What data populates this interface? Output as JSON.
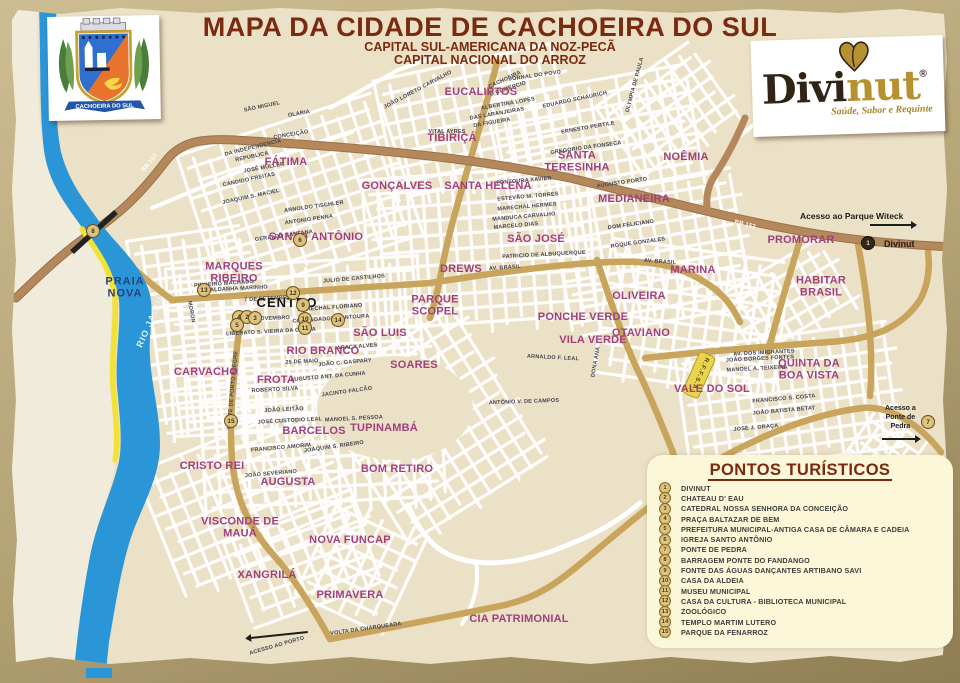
{
  "header": {
    "title": "MAPA DA CIDADE DE CACHOEIRA DO SUL",
    "subtitle1": "CAPITAL SUL-AMERICANA DA NOZ-PECÃ",
    "subtitle2": "CAPITAL NACIONAL DO ARROZ"
  },
  "crest": {
    "banner": "CACHOEIRA DO SUL"
  },
  "logo": {
    "word_dark": "Divi",
    "word_gold": "nut",
    "registered": "®",
    "tagline": "Saúde, Sabor e Requinte"
  },
  "map": {
    "river_label": "RIO JACUÍ",
    "railway_label": "R.F.F.S.A.",
    "access_parque": "Acesso ao Parque Witeck",
    "access_parque_marker_label": "Divinut",
    "access_ponte": "Acesso a\nPonte de\nPedra",
    "access_porto": "ACESSO AO PORTO",
    "colors": {
      "district": "#a13f7e",
      "river": "#2a96d8",
      "beach": "#f2e234",
      "main_road": "#b5885c",
      "avenue": "#c8a45c",
      "legend_bg": "#fcf7d8",
      "title": "#7a2a10"
    },
    "districts": [
      {
        "label": "EUCALIPTOS",
        "x": 481,
        "y": 93
      },
      {
        "label": "TIBIRIÇÁ",
        "x": 452,
        "y": 139
      },
      {
        "label": "SANTA\nTERESINHA",
        "x": 577,
        "y": 162
      },
      {
        "label": "NOÊMIA",
        "x": 686,
        "y": 158
      },
      {
        "label": "FÁTIMA",
        "x": 286,
        "y": 163
      },
      {
        "label": "GONÇALVES",
        "x": 397,
        "y": 187
      },
      {
        "label": "SANTA HELENA",
        "x": 488,
        "y": 187
      },
      {
        "label": "MEDIANEIRA",
        "x": 634,
        "y": 200
      },
      {
        "label": "SANTO ANTÔNIO",
        "x": 316,
        "y": 238
      },
      {
        "label": "SÃO JOSÉ",
        "x": 536,
        "y": 240
      },
      {
        "label": "PROMORAR",
        "x": 801,
        "y": 241
      },
      {
        "label": "MARQUES\nRIBEIRO",
        "x": 234,
        "y": 273
      },
      {
        "label": "DREWS",
        "x": 461,
        "y": 270
      },
      {
        "label": "MARINA",
        "x": 693,
        "y": 271
      },
      {
        "label": "HABITAR\nBRASIL",
        "x": 821,
        "y": 287
      },
      {
        "label": "PARQUE\nSCOPEL",
        "x": 435,
        "y": 306
      },
      {
        "label": "OLIVEIRA",
        "x": 639,
        "y": 297
      },
      {
        "label": "CENTRO",
        "x": 287,
        "y": 303,
        "v": "black"
      },
      {
        "label": "PONCHE VERDE",
        "x": 583,
        "y": 318
      },
      {
        "label": "VILA VERDE",
        "x": 593,
        "y": 341
      },
      {
        "label": "OTAVIANO",
        "x": 641,
        "y": 334
      },
      {
        "label": "SÃO LUIS",
        "x": 380,
        "y": 334
      },
      {
        "label": "RIO BRANCO",
        "x": 323,
        "y": 352
      },
      {
        "label": "SOARES",
        "x": 414,
        "y": 366
      },
      {
        "label": "CARVACHO",
        "x": 206,
        "y": 373
      },
      {
        "label": "FROTA",
        "x": 276,
        "y": 381
      },
      {
        "label": "VALE DO SOL",
        "x": 712,
        "y": 390
      },
      {
        "label": "QUINTA DA\nBOA VISTA",
        "x": 809,
        "y": 370
      },
      {
        "label": "BARCELOS",
        "x": 314,
        "y": 432
      },
      {
        "label": "TUPINAMBÁ",
        "x": 384,
        "y": 429
      },
      {
        "label": "CRISTO REI",
        "x": 212,
        "y": 467
      },
      {
        "label": "AUGUSTA",
        "x": 288,
        "y": 483
      },
      {
        "label": "BOM RETIRO",
        "x": 397,
        "y": 470
      },
      {
        "label": "VISCONDE DE\nMAUÁ",
        "x": 240,
        "y": 528
      },
      {
        "label": "NOVA FUNCAP",
        "x": 350,
        "y": 541
      },
      {
        "label": "XANGRILÁ",
        "x": 267,
        "y": 576
      },
      {
        "label": "PRIMAVERA",
        "x": 350,
        "y": 596
      },
      {
        "label": "CIA PATRIMONIAL",
        "x": 519,
        "y": 620
      },
      {
        "label": "PRAIA\nNOVA",
        "x": 125,
        "y": 288,
        "v": "navy"
      }
    ],
    "streets": [
      {
        "t": "CACHOEIRA",
        "x": 505,
        "y": 80,
        "r": -25
      },
      {
        "t": "JORNAL DO POVO",
        "x": 535,
        "y": 76,
        "r": -8
      },
      {
        "t": "O COMERCIO",
        "x": 508,
        "y": 89,
        "r": -18
      },
      {
        "t": "SÃO MIGUEL",
        "x": 262,
        "y": 107,
        "r": -12
      },
      {
        "t": "OLARIA",
        "x": 299,
        "y": 114,
        "r": -10
      },
      {
        "t": "CONCEIÇÃO",
        "x": 291,
        "y": 135,
        "r": -10
      },
      {
        "t": "EDUARDO SCHAURICH",
        "x": 575,
        "y": 100,
        "r": -12
      },
      {
        "t": "ALBERTINA LOPES",
        "x": 508,
        "y": 104,
        "r": -10
      },
      {
        "t": "DAS LARANJEIRAS",
        "x": 497,
        "y": 114,
        "r": -10
      },
      {
        "t": "DA FIGUEIRA",
        "x": 492,
        "y": 123,
        "r": -10
      },
      {
        "t": "ERNESTO PERTILE",
        "x": 588,
        "y": 128,
        "r": -10
      },
      {
        "t": "GREGORIO DA FONSECA",
        "x": 586,
        "y": 148,
        "r": -8
      },
      {
        "t": "VITAL AYRES",
        "x": 447,
        "y": 132,
        "r": 0
      },
      {
        "t": "OLYMPIA DE PAULA",
        "x": 635,
        "y": 85,
        "r": -75
      },
      {
        "t": "FONTOURA XAVIER",
        "x": 524,
        "y": 181,
        "r": -5
      },
      {
        "t": "ESTEVÃO M. TORRES",
        "x": 528,
        "y": 197,
        "r": -5
      },
      {
        "t": "MARECHAL HERMES",
        "x": 527,
        "y": 207,
        "r": -5
      },
      {
        "t": "MANDUCA CARVALHO",
        "x": 524,
        "y": 217,
        "r": -5
      },
      {
        "t": "MARCELO DIAS",
        "x": 516,
        "y": 226,
        "r": -5
      },
      {
        "t": "DA INDEPENDENCIA",
        "x": 253,
        "y": 148,
        "r": -14
      },
      {
        "t": "REPUBLICA",
        "x": 252,
        "y": 157,
        "r": -12
      },
      {
        "t": "JOSÉ MÜLLER",
        "x": 264,
        "y": 168,
        "r": -10
      },
      {
        "t": "CANDIDO FREITAS",
        "x": 249,
        "y": 180,
        "r": -12
      },
      {
        "t": "JOAQUIM S. MACIEL",
        "x": 251,
        "y": 197,
        "r": -12
      },
      {
        "t": "ARNOLDO TISCHLER",
        "x": 314,
        "y": 207,
        "r": -8
      },
      {
        "t": "ANTONIO PENNA",
        "x": 309,
        "y": 220,
        "r": -8
      },
      {
        "t": "GERALDO SANTANA",
        "x": 284,
        "y": 236,
        "r": -8
      },
      {
        "t": "PINHEIRO MACHADO",
        "x": 224,
        "y": 284,
        "r": -4
      },
      {
        "t": "SALDANHA MARINHO",
        "x": 237,
        "y": 289,
        "r": -3
      },
      {
        "t": "7 DE SETEMBRO",
        "x": 268,
        "y": 299,
        "r": -3
      },
      {
        "t": "15 DE NOVEMBRO",
        "x": 264,
        "y": 319,
        "r": -2
      },
      {
        "t": "MORON",
        "x": 191,
        "y": 312,
        "r": 80
      },
      {
        "t": "JULIO DE CASTILHOS",
        "x": 354,
        "y": 279,
        "r": -5
      },
      {
        "t": "MARECHAL FLORIANO",
        "x": 330,
        "y": 308,
        "r": -4
      },
      {
        "t": "COMENDADOR FONTOURA",
        "x": 331,
        "y": 319,
        "r": -4
      },
      {
        "t": "LIBERATO S. VIEIRA DA CUNHA",
        "x": 271,
        "y": 332,
        "r": -3
      },
      {
        "t": "AUGUSTO PORTO",
        "x": 622,
        "y": 183,
        "r": -8
      },
      {
        "t": "DOM FELICIANO",
        "x": 631,
        "y": 225,
        "r": -8
      },
      {
        "t": "ROQUE GONZALES",
        "x": 638,
        "y": 243,
        "r": -8
      },
      {
        "t": "PATRICIO DE ALBUQUERQUE",
        "x": 544,
        "y": 255,
        "r": -3
      },
      {
        "t": "AV. BRASIL",
        "x": 505,
        "y": 268,
        "r": -4
      },
      {
        "t": "AV. BRASIL",
        "x": 660,
        "y": 262,
        "r": 4
      },
      {
        "t": "DONA ANA",
        "x": 596,
        "y": 362,
        "r": -80
      },
      {
        "t": "ARNALDO F. LEAL",
        "x": 553,
        "y": 358,
        "r": 3
      },
      {
        "t": "ANTÔNIO V. DE CAMPOS",
        "x": 524,
        "y": 402,
        "r": -2
      },
      {
        "t": "ARACY ALVES",
        "x": 357,
        "y": 347,
        "r": -5
      },
      {
        "t": "JOÃO C. GASPARY",
        "x": 345,
        "y": 363,
        "r": -5
      },
      {
        "t": "25 DE MAIO",
        "x": 302,
        "y": 362,
        "r": -3
      },
      {
        "t": "AUGUSTO ANT. DA CUNHA",
        "x": 328,
        "y": 377,
        "r": -5
      },
      {
        "t": "ROBERTO SILVA",
        "x": 275,
        "y": 390,
        "r": -3
      },
      {
        "t": "JOÃO LEITÃO",
        "x": 284,
        "y": 410,
        "r": -3
      },
      {
        "t": "JOSÉ CUSTODIO LEAL",
        "x": 290,
        "y": 421,
        "r": -3
      },
      {
        "t": "MANOEL S. PESSOA",
        "x": 354,
        "y": 419,
        "r": -3
      },
      {
        "t": "JACINTO FALCÃO",
        "x": 347,
        "y": 392,
        "r": -8
      },
      {
        "t": "JOAQUIM S. RIBEIRO",
        "x": 334,
        "y": 447,
        "r": -8
      },
      {
        "t": "FRANCISCO AMORIM",
        "x": 281,
        "y": 448,
        "r": -5
      },
      {
        "t": "JOÃO SEVERIANO",
        "x": 271,
        "y": 474,
        "r": -5
      },
      {
        "t": "COMTE DE PORTO ALEGRE",
        "x": 233,
        "y": 390,
        "r": -85
      },
      {
        "t": "AV. DOS IMIGRANTES",
        "x": 764,
        "y": 353,
        "r": -3
      },
      {
        "t": "JOÃO BORGES FONTES",
        "x": 760,
        "y": 359,
        "r": -3
      },
      {
        "t": "MANOEL A. TEIXEIRA",
        "x": 757,
        "y": 369,
        "r": -3
      },
      {
        "t": "FRANCISCO S. COSTA",
        "x": 784,
        "y": 399,
        "r": -5
      },
      {
        "t": "JOÃO BATISTA BETAT",
        "x": 784,
        "y": 411,
        "r": -5
      },
      {
        "t": "JOSÉ J. GRAÇA",
        "x": 756,
        "y": 428,
        "r": -5
      },
      {
        "t": "VOLTA DA CHARQUEADA",
        "x": 366,
        "y": 629,
        "r": -8
      },
      {
        "t": "BR 153",
        "x": 150,
        "y": 163,
        "r": -52,
        "v": "w"
      },
      {
        "t": "BR 153",
        "x": 745,
        "y": 225,
        "r": 14,
        "v": "w"
      },
      {
        "t": "JOÃO LORETO CARVALHO",
        "x": 418,
        "y": 90,
        "r": -28
      }
    ],
    "markers": [
      {
        "n": "8",
        "x": 93,
        "y": 231
      },
      {
        "n": "13",
        "x": 204,
        "y": 290
      },
      {
        "n": "15",
        "x": 231,
        "y": 421
      },
      {
        "n": "12",
        "x": 293,
        "y": 293
      },
      {
        "n": "9",
        "x": 303,
        "y": 305
      },
      {
        "n": "4",
        "x": 239,
        "y": 317
      },
      {
        "n": "2",
        "x": 247,
        "y": 317
      },
      {
        "n": "3",
        "x": 255,
        "y": 318
      },
      {
        "n": "5",
        "x": 237,
        "y": 325
      },
      {
        "n": "10",
        "x": 305,
        "y": 319
      },
      {
        "n": "11",
        "x": 305,
        "y": 328
      },
      {
        "n": "14",
        "x": 338,
        "y": 320
      },
      {
        "n": "6",
        "x": 300,
        "y": 240
      },
      {
        "n": "1",
        "x": 868,
        "y": 243,
        "dark": true
      },
      {
        "n": "7",
        "x": 928,
        "y": 422
      }
    ]
  },
  "legend": {
    "title": "PONTOS TURÍSTICOS",
    "items": [
      {
        "n": "1",
        "label": "DIVINUT"
      },
      {
        "n": "2",
        "label": "CHATEAU D' EAU"
      },
      {
        "n": "3",
        "label": "CATEDRAL NOSSA SENHORA DA CONCEIÇÃO"
      },
      {
        "n": "4",
        "label": "PRAÇA BALTAZAR DE BEM"
      },
      {
        "n": "5",
        "label": "PREFEITURA MUNICIPAL-ANTIGA CASA DE CÂMARA E CADEIA"
      },
      {
        "n": "6",
        "label": "IGREJA SANTO ANTÔNIO"
      },
      {
        "n": "7",
        "label": "PONTE DE PEDRA"
      },
      {
        "n": "8",
        "label": "BARRAGEM PONTE DO FANDANGO"
      },
      {
        "n": "9",
        "label": "FONTE DAS ÁGUAS DANÇANTES ARTIBANO SAVI"
      },
      {
        "n": "10",
        "label": "CASA DA ALDEIA"
      },
      {
        "n": "11",
        "label": "MUSEU MUNICIPAL"
      },
      {
        "n": "12",
        "label": "CASA DA CULTURA - BIBLIOTECA MUNICIPAL"
      },
      {
        "n": "13",
        "label": "ZOOLÓGICO"
      },
      {
        "n": "14",
        "label": "TEMPLO MARTIM LUTERO"
      },
      {
        "n": "15",
        "label": "PARQUE DA FENARROZ"
      }
    ]
  }
}
